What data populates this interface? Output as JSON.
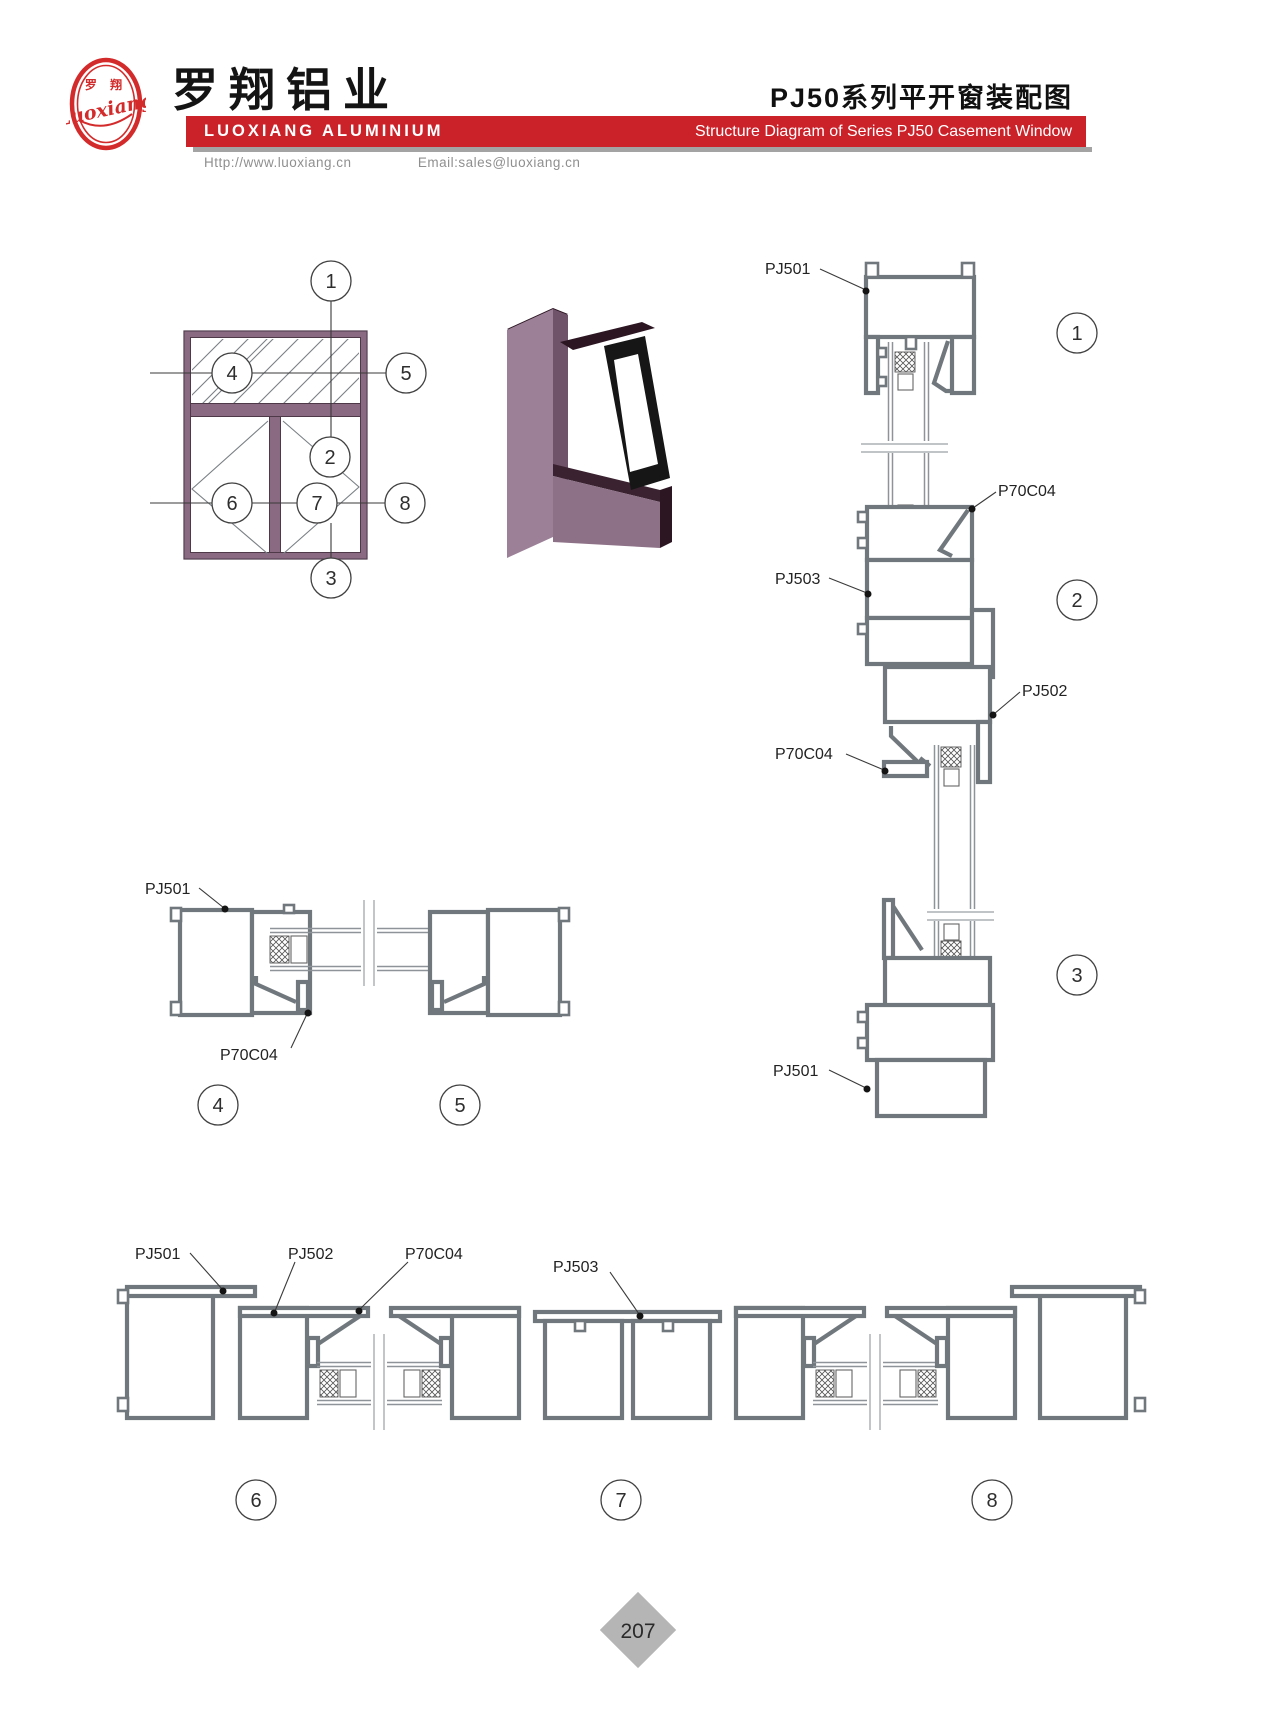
{
  "page": {
    "number": "207"
  },
  "header": {
    "logo_chars": "罗 翔",
    "logo_script": "Luoxiang",
    "brand_cn": "罗翔铝业",
    "brand_en": "LUOXIANG ALUMINIUM",
    "doc_title_cn": "PJ50系列平开窗装配图",
    "doc_title_en": "Structure Diagram of Series PJ50 Casement Window",
    "website": "Http://www.luoxiang.cn",
    "email": "Email:sales@luoxiang.cn"
  },
  "colors": {
    "brand_red": "#cb2129",
    "frame_purple": "#8a6a82",
    "frame_purple_dark": "#4e3949",
    "line_gray": "#71787d"
  },
  "drawing_labels": {
    "pj501": "PJ501",
    "pj502": "PJ502",
    "pj503": "PJ503",
    "p70c04": "P70C04"
  },
  "callouts": {
    "c1": "1",
    "c2": "2",
    "c3": "3",
    "c4": "4",
    "c5": "5",
    "c6": "6",
    "c7": "7",
    "c8": "8"
  }
}
